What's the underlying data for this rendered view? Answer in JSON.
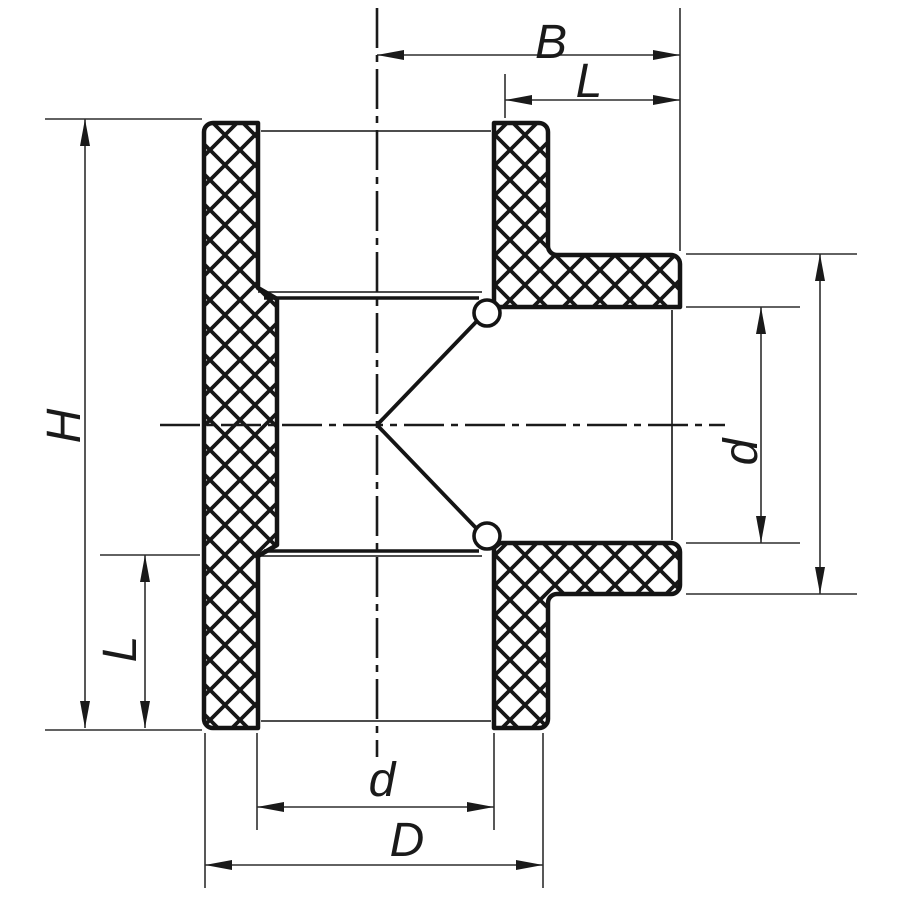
{
  "drawing": {
    "title": "Tee fitting cross-section",
    "colors": {
      "background": "#ffffff",
      "outline": "#141414",
      "thin_line": "#2e2e2e"
    },
    "labels": {
      "b": "B",
      "l_top": "L",
      "h": "H",
      "l_bottom": "L",
      "d_branch": "d",
      "d_socket": "d",
      "d_outer": "D"
    }
  }
}
